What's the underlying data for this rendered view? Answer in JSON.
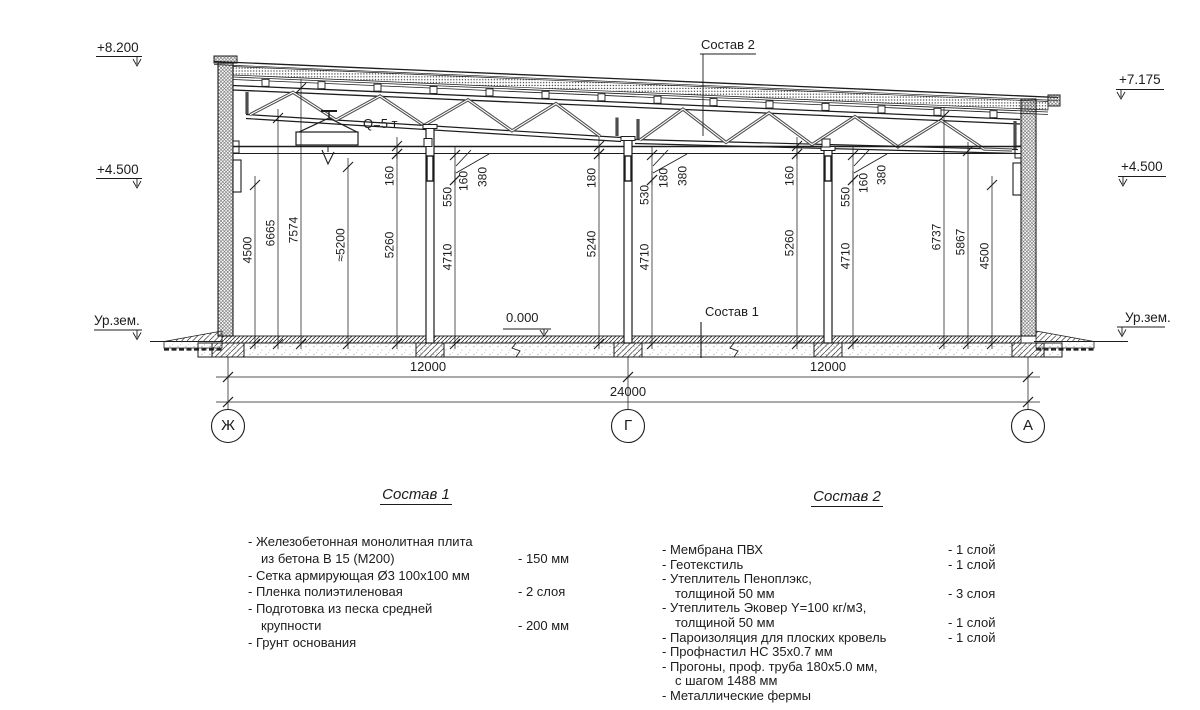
{
  "drawing": {
    "elevation_marks": [
      {
        "label": "+8.200"
      },
      {
        "label": "+4.500"
      },
      {
        "label": "Ур.зем."
      },
      {
        "label": "+7.175"
      },
      {
        "label": "+4.500"
      },
      {
        "label": "Ур.зем."
      }
    ],
    "callouts": {
      "roof_composition": "Состав 2",
      "floor_composition": "Состав 1",
      "zero_level": "0.000",
      "crane_capacity": "Q=5 т"
    },
    "vertical_dims": [
      {
        "label": "4500",
        "x": 255,
        "y1": 185,
        "y2": 344,
        "ly": 250
      },
      {
        "label": "6665",
        "x": 278,
        "y1": 118,
        "y2": 344,
        "ly": 233
      },
      {
        "label": "7574",
        "x": 301,
        "y1": 88,
        "y2": 344,
        "ly": 230
      },
      {
        "label": "≈5200",
        "x": 348,
        "y1": 167,
        "y2": 344,
        "ly": 245
      },
      {
        "label": "160",
        "x": 397,
        "y1": 146,
        "y2": 154,
        "ly": 176
      },
      {
        "label": "5260",
        "x": 397,
        "y1": 154,
        "y2": 344,
        "ly": 245
      },
      {
        "label": "550",
        "x": 455,
        "y1": 155,
        "y2": 180,
        "ly": 197
      },
      {
        "label": "4710",
        "x": 455,
        "y1": 180,
        "y2": 344,
        "ly": 257
      },
      {
        "label": "160",
        "x": 471,
        "ly": 181
      },
      {
        "label": "380",
        "x": 490,
        "ly": 177
      },
      {
        "label": "180",
        "x": 599,
        "y1": 146,
        "y2": 154,
        "ly": 178
      },
      {
        "label": "5240",
        "x": 599,
        "y1": 154,
        "y2": 344,
        "ly": 244
      },
      {
        "label": "530",
        "x": 652,
        "y1": 155,
        "y2": 180,
        "ly": 195
      },
      {
        "label": "4710",
        "x": 652,
        "y1": 180,
        "y2": 344,
        "ly": 257
      },
      {
        "label": "180",
        "x": 671,
        "ly": 178
      },
      {
        "label": "380",
        "x": 690,
        "ly": 176
      },
      {
        "label": "160",
        "x": 797,
        "y1": 146,
        "y2": 154,
        "ly": 176
      },
      {
        "label": "5260",
        "x": 797,
        "y1": 154,
        "y2": 344,
        "ly": 243
      },
      {
        "label": "550",
        "x": 853,
        "y1": 155,
        "y2": 180,
        "ly": 197
      },
      {
        "label": "4710",
        "x": 853,
        "y1": 180,
        "y2": 344,
        "ly": 256
      },
      {
        "label": "160",
        "x": 871,
        "ly": 183
      },
      {
        "label": "380",
        "x": 889,
        "ly": 175
      },
      {
        "label": "6737",
        "x": 944,
        "y1": 116,
        "y2": 344,
        "ly": 237
      },
      {
        "label": "5867",
        "x": 968,
        "y1": 151,
        "y2": 344,
        "ly": 242
      },
      {
        "label": "4500",
        "x": 992,
        "y1": 185,
        "y2": 344,
        "ly": 256
      }
    ],
    "bottom_dims": [
      "12000",
      "12000",
      "24000"
    ],
    "grid_bubbles": [
      "Ж",
      "Г",
      "А"
    ]
  },
  "notes": {
    "sostav1": {
      "title": "Состав 1",
      "items": [
        {
          "text": "- Железобетонная монолитная плита",
          "value": ""
        },
        {
          "text": "из бетона В 15 (М200)",
          "indent": true,
          "value": "- 150 мм"
        },
        {
          "text": "- Сетка армирующая Ø3 100х100 мм",
          "value": ""
        },
        {
          "text": "- Пленка полиэтиленовая",
          "value": "- 2 слоя"
        },
        {
          "text": "- Подготовка из песка средней",
          "value": ""
        },
        {
          "text": "крупности",
          "indent": true,
          "value": "- 200 мм"
        },
        {
          "text": "- Грунт основания",
          "value": ""
        }
      ]
    },
    "sostav2": {
      "title": "Состав 2",
      "items": [
        {
          "text": "- Мембрана ПВХ",
          "value": "- 1 слой"
        },
        {
          "text": "- Геотекстиль",
          "value": "- 1 слой"
        },
        {
          "text": "- Утеплитель Пеноплэкс,",
          "value": ""
        },
        {
          "text": "толщиной 50 мм",
          "indent": true,
          "value": "- 3 слоя"
        },
        {
          "text": "- Утеплитель Эковер Y=100 кг/м3,",
          "value": ""
        },
        {
          "text": "толщиной 50 мм",
          "indent": true,
          "value": "- 1 слой"
        },
        {
          "text": "- Пароизоляция для плоских кровель",
          "value": "- 1 слой"
        },
        {
          "text": "- Профнастил НС 35х0.7 мм",
          "value": ""
        },
        {
          "text": "- Прогоны, проф. труба 180х5.0 мм,",
          "value": ""
        },
        {
          "text": "с шагом 1488 мм",
          "indent": true,
          "value": ""
        },
        {
          "text": "- Металлические фермы",
          "value": ""
        }
      ]
    }
  }
}
